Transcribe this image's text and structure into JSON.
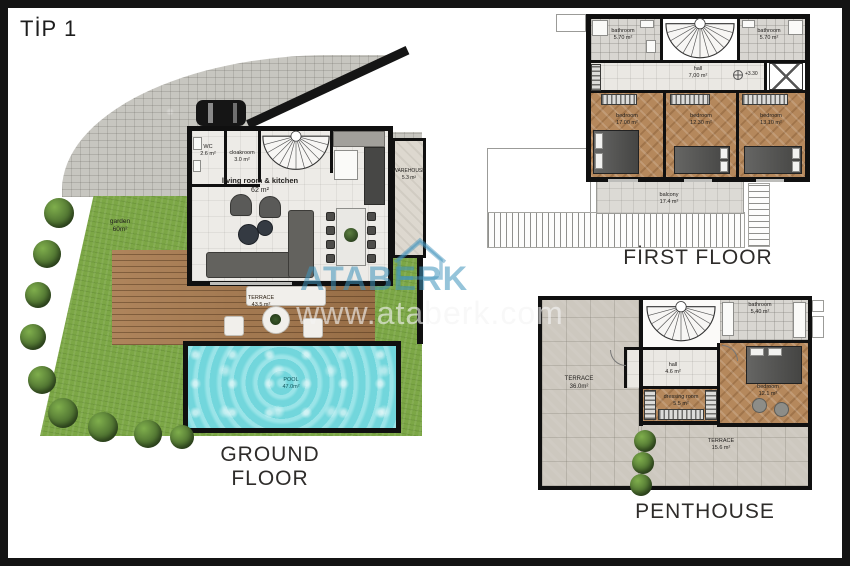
{
  "title": "TİP 1",
  "watermark": {
    "brand": "ATABERK",
    "url": "www.ataberk.com"
  },
  "colors": {
    "watermark_blue": "#3e94bc",
    "pool_water": "#7edde2",
    "grass_green": "#7ca746",
    "deck_wood": "#a87a4e",
    "wall_black": "#101010"
  },
  "ground": {
    "floor_label": "GROUND FLOOR",
    "rooms": {
      "wc": {
        "label": "WC",
        "area": "2.6 m²"
      },
      "cloakroom": {
        "label": "cloakroom",
        "area": "3.0 m²"
      },
      "living": {
        "label": "living room & kitchen",
        "area": "62 m²"
      },
      "warehouse": {
        "label": "WAREHOUSE",
        "area": "5.3 m²"
      },
      "garden": {
        "label": "garden",
        "area": "60m²"
      },
      "terrace": {
        "label": "TERRACE",
        "area": "43.5 m²"
      },
      "pool": {
        "label": "POOL",
        "area": "47.0m²"
      }
    }
  },
  "first": {
    "floor_label": "FİRST FLOOR",
    "elevation": "+3.30",
    "rooms": {
      "bathroom_left": {
        "label": "bathroom",
        "area": "5.70 m²"
      },
      "bathroom_right": {
        "label": "bathroom",
        "area": "5.70 m²"
      },
      "hall": {
        "label": "hall",
        "area": "7,00 m²"
      },
      "bedroom_1": {
        "label": "bedroom",
        "area": "17.00 m²"
      },
      "bedroom_2": {
        "label": "bedroom",
        "area": "12.30 m²"
      },
      "bedroom_3": {
        "label": "bedroom",
        "area": "13.10 m²"
      },
      "balcony": {
        "label": "balcony",
        "area": "17.4 m²"
      }
    }
  },
  "penthouse": {
    "floor_label": "PENTHOUSE",
    "rooms": {
      "terrace_main": {
        "label": "TERRACE",
        "area": "36.0m²"
      },
      "hall": {
        "label": "hall",
        "area": "4.6 m²"
      },
      "dressing": {
        "label": "dressing room",
        "area": "5.5 m²"
      },
      "bathroom": {
        "label": "bathroom",
        "area": "5,40 m²"
      },
      "bedroom": {
        "label": "bedroom",
        "area": "12.1 m²"
      },
      "terrace_lower": {
        "label": "TERRACE",
        "area": "15.6 m²"
      }
    }
  }
}
